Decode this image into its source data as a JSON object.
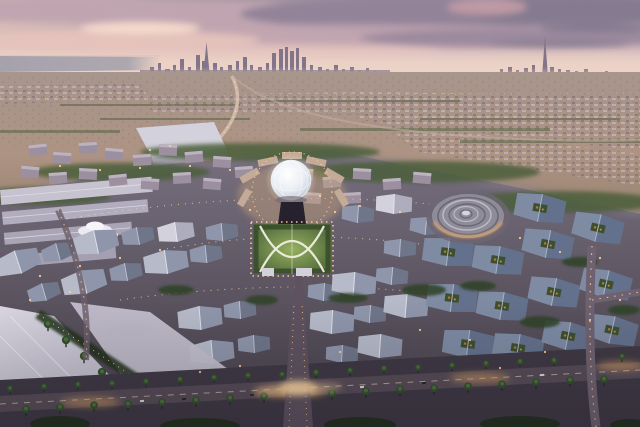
{
  "image": {
    "description": "Aerial dusk rendering of a vast circular expo city site in the desert: glowing lattice dome and garden square at the center, a ringed disc pavilion to the right, clusters of grey gabled pavilion roofs, palm-lined illuminated boulevards, desert plain and a distant high-rise city skyline under a pink and grey sunset sky"
  },
  "scene": {
    "sky": "sunset clouds, pink left, grey-purple right",
    "horizon": [
      "sea strip on left",
      "main city skyline with tall spire",
      "far right thin super-tall spire"
    ],
    "midground": [
      "desert plain",
      "low suburbs",
      "curving highway",
      "metro viaduct and white station canopy"
    ],
    "site_landmarks": [
      "glowing-dome",
      "garden-square-with-arc-paths",
      "ringed-disc-pavilion",
      "white-petal-canopy",
      "warehouse-roofs",
      "pavilion-roof-clusters",
      "palm-boulevard",
      "lit-avenue-intersection"
    ]
  },
  "palette": {
    "sky_top": "#96889c",
    "sky_mid": "#c3a8b2",
    "sky_low": "#ecd2ca",
    "sky_horizon": "#f3dcd0",
    "sunset_warm": "#f6d5c3",
    "cloud_pink": "#e7c4bd",
    "cloud_mauve": "#c0a5b0",
    "cloud_dark": "#857a90",
    "cloud_slate": "#938399",
    "sea": "#a6a2ac",
    "skyline": "#7d7186",
    "haze": "#ecd3c6",
    "desert_light": "#a8958d",
    "desert_mid": "#ad9383",
    "desert_dark": "#97816f",
    "scrub_green": "#5c6747",
    "suburb_light": "#cfc6cd",
    "suburb_dark": "#746878",
    "road_light": "#d7c0ae",
    "ground_upper": "#787080",
    "ground_mid": "#5f5864",
    "ground_lower": "#46404b",
    "warehouse_light": "#c6c2d0",
    "warehouse_mid": "#b1adbe",
    "roof_light": "#b6bac9",
    "roof_mid": "#8f96ab",
    "roof_dark": "#6f7689",
    "roof_white": "#d3d2dc",
    "roof_white_shade": "#aeadbd",
    "roof_blue": "#7e8ba3",
    "roof_blue_dark": "#64718c",
    "block_wall": "#9c90a0",
    "block_top": "#bcb2c0",
    "green_dark": "#2f4227",
    "green_mid": "#4b5e3a",
    "palm_green": "#33502c",
    "palm_light": "#4e7040",
    "road_dark": "#564c57",
    "asphalt": "#5e5260",
    "light_warm": "#ffcf92",
    "glow_amber": "#e8a964",
    "plaza_warm": "#d2a97e",
    "dome_core": "#ffffff",
    "dome_edge": "#b7c1d0",
    "garden_light": "#97b060",
    "garden_dark": "#5a7340",
    "path_cream": "#eef0e0",
    "disc_base": "#8f8c99",
    "disc_ring_light": "#bdbac6",
    "disc_ring_dark": "#6b6876",
    "canopy_white": "#eceaf0",
    "dark_building": "#26212c",
    "tree_shadow": "#23301f"
  }
}
